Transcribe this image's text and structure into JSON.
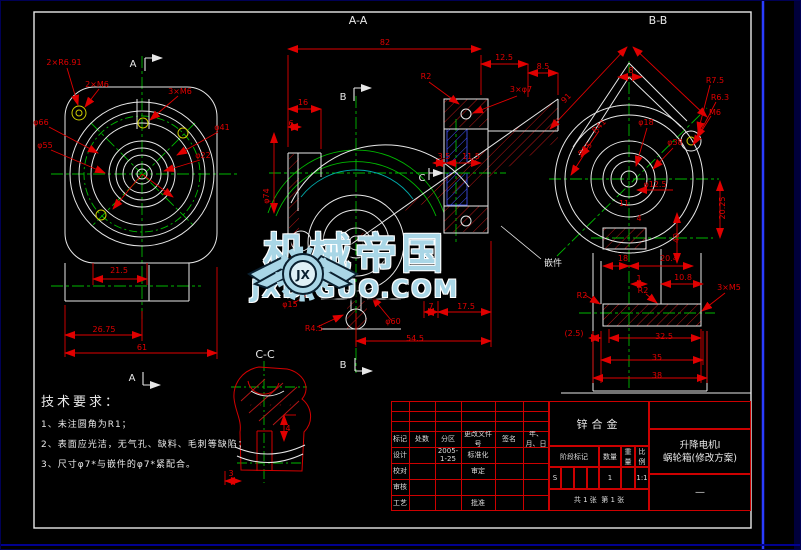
{
  "colors": {
    "dim": "#e00000",
    "line": "#e8e8e8",
    "center": "#00b800",
    "insert": "#4455ff",
    "table": "#cc0000",
    "watermark": "#a9d6e6",
    "hole": "#cccc00",
    "frame_blue": "#2a3cff"
  },
  "watermark": {
    "brand": "机械帝国",
    "url": "JXDIGUO.COM",
    "logo_monogram": "JX"
  },
  "tech": {
    "title": "技术要求：",
    "item1": "1、未注圆角为R1；",
    "item2": "2、表面应光洁，无气孔、缺料、毛刺等缺陷；",
    "item3": "3、尺寸φ7*与嵌件的φ7*紧配合。"
  },
  "title_block": {
    "rev_headers": [
      "标记",
      "处数",
      "分区",
      "更改文件号",
      "签名",
      "年、月、日"
    ],
    "roles": {
      "design": "设计",
      "check": "校对",
      "review": "审核",
      "process": "工艺",
      "standard": "标准化",
      "approve_std": "审定",
      "approve": "批准"
    },
    "date": "2005-1-25",
    "material": "锌合金",
    "stage_label": "阶段标记",
    "qty_label": "数量",
    "weight_label": "重量",
    "scale_label": "比例",
    "stage_value": "S",
    "qty_value": "1",
    "scale_value": "1:1",
    "sheets_total": "共 1 张",
    "sheet_no": "第 1 张",
    "product_line1": "升降电机Ⅰ",
    "product_line2": "蜗轮箱(修改方案)",
    "extra": "—"
  },
  "annotations": [
    {
      "t": "2×R6.91",
      "x": 63,
      "y": 64
    },
    {
      "t": "2×M6",
      "x": 96,
      "y": 86
    },
    {
      "t": "3×M6",
      "x": 179,
      "y": 93
    },
    {
      "t": "φ66",
      "x": 40,
      "y": 124
    },
    {
      "t": "φ55",
      "x": 44,
      "y": 147
    },
    {
      "t": "φ41",
      "x": 221,
      "y": 129
    },
    {
      "t": "φ22",
      "x": 202,
      "y": 157
    },
    {
      "t": "21.5",
      "x": 118,
      "y": 272
    },
    {
      "t": "26.75",
      "x": 103,
      "y": 331
    },
    {
      "t": "61",
      "x": 141,
      "y": 349
    },
    {
      "t": "A",
      "x": 132,
      "y": 66,
      "c": "w",
      "s": 10,
      "n": "section-marker-a-top"
    },
    {
      "t": "A",
      "x": 131,
      "y": 380,
      "c": "w",
      "s": 10,
      "n": "section-marker-a-bottom"
    },
    {
      "t": "A-A",
      "x": 357,
      "y": 23,
      "c": "w",
      "s": 11,
      "n": "view-title-aa"
    },
    {
      "t": "82",
      "x": 384,
      "y": 44
    },
    {
      "t": "12.5",
      "x": 503,
      "y": 59
    },
    {
      "t": "8.5",
      "x": 542,
      "y": 68
    },
    {
      "t": "3×φ7",
      "x": 520,
      "y": 91
    },
    {
      "t": "16",
      "x": 302,
      "y": 104
    },
    {
      "t": "6",
      "x": 290,
      "y": 125
    },
    {
      "t": "R2",
      "x": 425,
      "y": 78
    },
    {
      "t": "φ74",
      "x": 268,
      "y": 195,
      "r": -90
    },
    {
      "t": "3.5",
      "x": 443,
      "y": 158
    },
    {
      "t": "11.5",
      "x": 470,
      "y": 158
    },
    {
      "t": "C",
      "x": 421,
      "y": 180,
      "c": "w",
      "s": 10,
      "n": "section-marker-c"
    },
    {
      "t": "φ15",
      "x": 289,
      "y": 306
    },
    {
      "t": "R4.5",
      "x": 313,
      "y": 330
    },
    {
      "t": "φ60",
      "x": 392,
      "y": 323
    },
    {
      "t": "7",
      "x": 430,
      "y": 308
    },
    {
      "t": "17.5",
      "x": 465,
      "y": 308
    },
    {
      "t": "54.5",
      "x": 414,
      "y": 340
    },
    {
      "t": "B",
      "x": 342,
      "y": 99,
      "c": "w",
      "s": 10,
      "n": "section-marker-b-top"
    },
    {
      "t": "B",
      "x": 342,
      "y": 367,
      "c": "w",
      "s": 10,
      "n": "section-marker-b-bottom"
    },
    {
      "t": "嵌件",
      "x": 552,
      "y": 265,
      "c": "w",
      "s": 9,
      "n": "insert-note"
    },
    {
      "t": "B-B",
      "x": 657,
      "y": 23,
      "c": "w",
      "s": 11,
      "n": "view-title-bb"
    },
    {
      "t": "91",
      "x": 567,
      "y": 99,
      "r": -45
    },
    {
      "t": "8",
      "x": 630,
      "y": 72
    },
    {
      "t": "R7.5",
      "x": 714,
      "y": 82
    },
    {
      "t": "R6.3",
      "x": 719,
      "y": 99
    },
    {
      "t": "M6",
      "x": 714,
      "y": 114
    },
    {
      "t": "φ18",
      "x": 645,
      "y": 124
    },
    {
      "t": "φ38",
      "x": 674,
      "y": 144
    },
    {
      "t": "R41",
      "x": 600,
      "y": 127,
      "r": -45
    },
    {
      "t": "R35",
      "x": 586,
      "y": 150,
      "r": -45
    },
    {
      "t": "φ12.5",
      "x": 654,
      "y": 186
    },
    {
      "t": "11",
      "x": 623,
      "y": 205
    },
    {
      "t": "4",
      "x": 638,
      "y": 220
    },
    {
      "t": "40",
      "x": 678,
      "y": 237,
      "r": -90
    },
    {
      "t": "20.25",
      "x": 724,
      "y": 207,
      "r": -90
    },
    {
      "t": "18",
      "x": 622,
      "y": 260
    },
    {
      "t": "20.4",
      "x": 668,
      "y": 260
    },
    {
      "t": "1",
      "x": 638,
      "y": 280
    },
    {
      "t": "10.8",
      "x": 682,
      "y": 279
    },
    {
      "t": "R2",
      "x": 581,
      "y": 297
    },
    {
      "t": "R2",
      "x": 642,
      "y": 292
    },
    {
      "t": "3×M5",
      "x": 728,
      "y": 289
    },
    {
      "t": "(2.5)",
      "x": 573,
      "y": 335
    },
    {
      "t": "32.5",
      "x": 663,
      "y": 338
    },
    {
      "t": "35",
      "x": 656,
      "y": 359
    },
    {
      "t": "38",
      "x": 656,
      "y": 377
    },
    {
      "t": "C-C",
      "x": 264,
      "y": 357,
      "c": "w",
      "s": 11,
      "n": "view-title-cc"
    },
    {
      "t": "4",
      "x": 287,
      "y": 430
    },
    {
      "t": "3",
      "x": 230,
      "y": 475
    }
  ]
}
